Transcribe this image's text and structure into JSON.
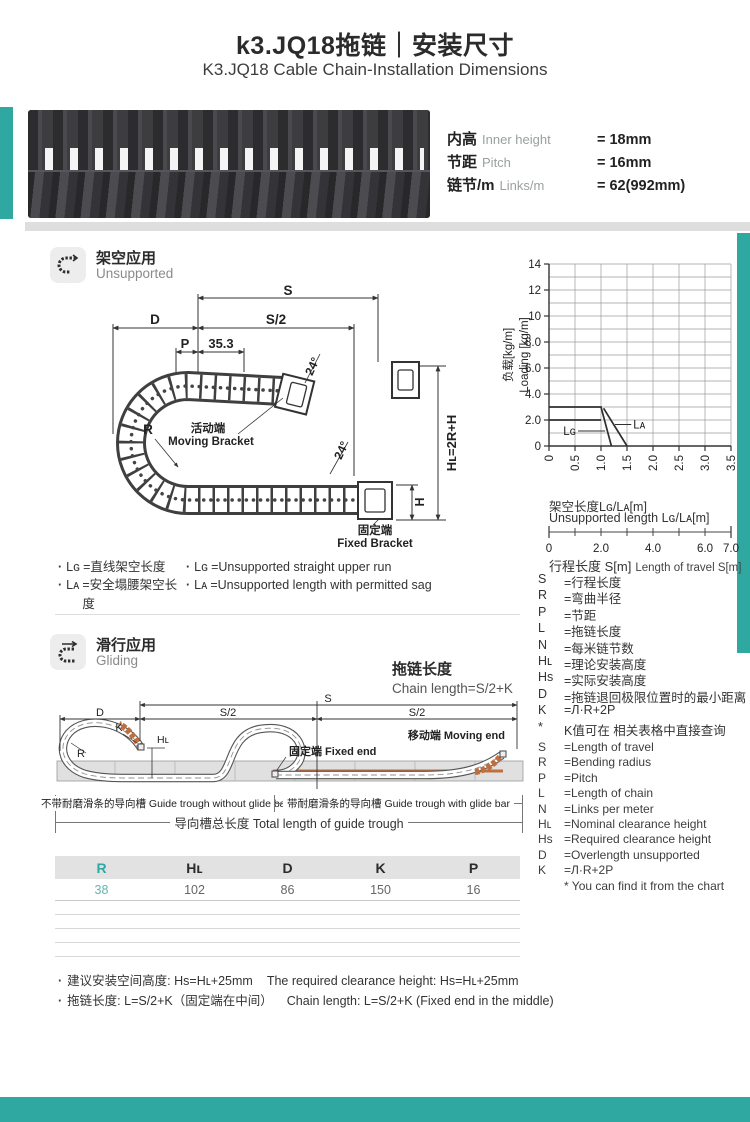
{
  "colors": {
    "accent": "#2FA8A2",
    "orange": "#BF6F3E",
    "photo_dark": "#3A3A3C",
    "table_header_bg": "#E2E2E2"
  },
  "header": {
    "title_cn": "k3.JQ18拖链｜安装尺寸",
    "title_en": "K3.JQ18 Cable Chain-Installation Dimensions"
  },
  "specs": {
    "rows": [
      {
        "cn": "内高",
        "en": "Inner height",
        "value": "= 18mm"
      },
      {
        "cn": "节距",
        "en": "Pitch",
        "value": "= 16mm"
      },
      {
        "cn": "链节/m",
        "en": "Links/m",
        "value": "= 62(992mm)"
      }
    ]
  },
  "icons": {
    "section_unsupported": "cable-chain-curve-icon",
    "section_gliding": "cable-chain-glide-icon"
  },
  "sections": {
    "unsupported": {
      "title_cn": "架空应用",
      "title_en": "Unsupported"
    },
    "gliding": {
      "title_cn": "滑行应用",
      "title_en": "Gliding"
    }
  },
  "drawing1": {
    "labels": {
      "s": "S",
      "d": "D",
      "s2": "S/2",
      "p": "P",
      "dim353": "35.3",
      "angle": "24°",
      "r": "R",
      "moving_cn": "活动端",
      "moving_en": "Moving Bracket",
      "fixed_cn": "固定端",
      "fixed_en": "Fixed Bracket",
      "hl": "Hʟ=2R+H",
      "h": "H"
    }
  },
  "legend": {
    "cn": [
      {
        "sym": "Lɢ",
        "text": "=直线架空长度"
      },
      {
        "sym": "Lᴀ",
        "text": "=安全塌腰架空长度"
      }
    ],
    "en": [
      {
        "sym": "Lɢ",
        "text": "=Unsupported straight upper run"
      },
      {
        "sym": "Lᴀ",
        "text": "=Unsupported length with permitted sag"
      }
    ]
  },
  "chart_data": {
    "type": "line",
    "ylabel_cn": "负载[kg/m]",
    "ylabel_en": "Loading [kg/m]",
    "xlabel_cn": "架空长度Lɢ/Lᴀ[m]",
    "xlabel_en": "Unsupported length Lɢ/Lᴀ[m]",
    "xlim": [
      0,
      3.5
    ],
    "ylim": [
      0,
      14
    ],
    "grid_x_step": 0.5,
    "grid_y_step": 1,
    "x_ticks": [
      0,
      0.5,
      1.0,
      1.5,
      2.0,
      2.5,
      3.0,
      3.5
    ],
    "x_tick_labels": [
      "0",
      "0.5",
      "1.0",
      "1.5",
      "2.0",
      "2.5",
      "3.0",
      "3.5"
    ],
    "y_ticks": [
      0,
      2,
      4,
      6,
      8,
      10,
      12,
      14
    ],
    "y_tick_labels": [
      "0",
      "2.0",
      "4.0",
      "6.0",
      "8.0",
      "10",
      "12",
      "14"
    ],
    "series": [
      {
        "name": "Lɢ",
        "points": [
          [
            0,
            3.0
          ],
          [
            1.0,
            3.0
          ],
          [
            1.2,
            0
          ]
        ]
      },
      {
        "name": "Lᴀ",
        "points": [
          [
            0,
            2.0
          ],
          [
            1.0,
            2.0
          ]
        ]
      },
      {
        "name": "Lᴀ",
        "points": [
          [
            1.05,
            2.9
          ],
          [
            1.5,
            0
          ]
        ]
      }
    ],
    "labels": [
      {
        "text": "Lɢ",
        "side": "left",
        "x": 0.52,
        "y": 1.15,
        "leader_to": [
          1.08,
          1.15
        ]
      },
      {
        "text": "Lᴀ",
        "side": "right",
        "x": 1.62,
        "y": 1.65,
        "leader_to": [
          1.27,
          1.65
        ]
      }
    ],
    "travel_scale": {
      "label_cn": "行程长度 S[m]",
      "label_en": "Length of travel S[m]",
      "min": 0,
      "max": 7,
      "tick_step": 1,
      "labeled_ticks": [
        0,
        2,
        4,
        6,
        7
      ],
      "labels": [
        "0",
        "2.0",
        "4.0",
        "6.0",
        "7.0"
      ]
    }
  },
  "defs_cn": [
    {
      "sym": "S",
      "text": "=行程长度"
    },
    {
      "sym": "R",
      "text": "=弯曲半径"
    },
    {
      "sym": "P",
      "text": "=节距"
    },
    {
      "sym": "L",
      "text": "=拖链长度"
    },
    {
      "sym": "N",
      "text": "=每米链节数"
    },
    {
      "sym": "Hʟ",
      "text": "=理论安装高度"
    },
    {
      "sym": "Hs",
      "text": "=实际安装高度"
    },
    {
      "sym": "D",
      "text": "=拖链退回极限位置时的最小距离"
    },
    {
      "sym": "K",
      "text": "=Л·R+2P"
    },
    {
      "sym": "*",
      "text": "K值可在 相关表格中直接查询"
    }
  ],
  "defs_en": [
    {
      "sym": "S",
      "text": "=Length of travel"
    },
    {
      "sym": "R",
      "text": "=Bending radius"
    },
    {
      "sym": "P",
      "text": "=Pitch"
    },
    {
      "sym": "L",
      "text": "=Length of chain"
    },
    {
      "sym": "N",
      "text": "=Links per meter"
    },
    {
      "sym": "Hʟ",
      "text": "=Nominal clearance height"
    },
    {
      "sym": "Hs",
      "text": "=Required clearance height"
    },
    {
      "sym": "D",
      "text": "=Overlength unsupported"
    },
    {
      "sym": "K",
      "text": "=Л·R+2P"
    },
    {
      "sym": "",
      "text": "* You can find it from the chart"
    }
  ],
  "chain_length": {
    "cn": "拖链长度",
    "en": "Chain length=S/2+K"
  },
  "drawing2": {
    "labels": {
      "d": "D",
      "s": "S",
      "s2": "S/2",
      "k": "K",
      "r": "R",
      "hl": "Hʟ",
      "fixed": "固定端 Fixed end",
      "moving": "移动端 Moving end"
    },
    "troughs": {
      "without": "不带耐磨滑条的导向槽 Guide trough without glide bar",
      "with": "带耐磨滑条的导向槽 Guide trough with glide bar",
      "total": "导向槽总长度 Total length of guide trough"
    }
  },
  "table": {
    "headers": [
      "R",
      "Hʟ",
      "D",
      "K",
      "P"
    ],
    "rows": [
      [
        "38",
        "102",
        "86",
        "150",
        "16"
      ]
    ],
    "empty_rows": 4
  },
  "notes": [
    {
      "cn": "建议安装空间高度: Hs=Hʟ+25mm",
      "en": "The required clearance height: Hs=Hʟ+25mm"
    },
    {
      "cn": "拖链长度: L=S/2+K（固定端在中间）",
      "en": "Chain length: L=S/2+K (Fixed end in the middle)"
    }
  ]
}
